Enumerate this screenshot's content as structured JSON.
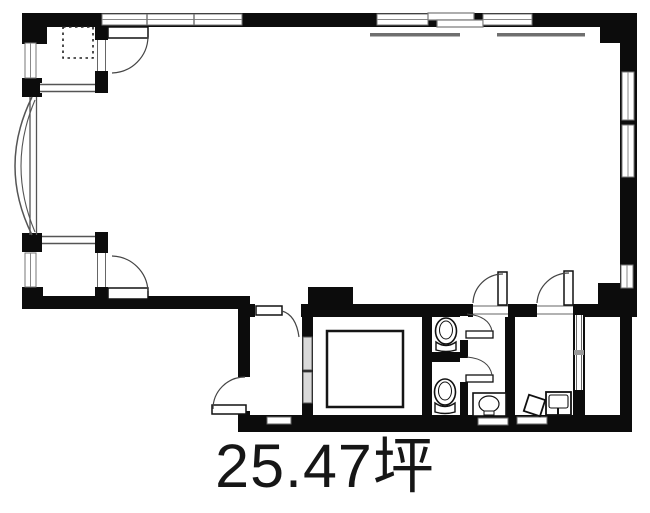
{
  "floor_plan": {
    "area_label": "25.47坪",
    "area_value": "25.47",
    "area_unit": "坪",
    "colors": {
      "wall": "#0c0c0c",
      "thin_line": "#555555",
      "door_arc": "#444444",
      "window_line": "#777777",
      "elevator_slot": "#d9d9d9",
      "background": "#ffffff",
      "text": "#161616"
    },
    "icons": [
      "toilet-icon",
      "toilet-icon",
      "washbasin-icon",
      "kitchen-sink-icon",
      "elevator-car",
      "bay-window",
      "door-swing-arc",
      "equipment-dotted-outline"
    ]
  }
}
